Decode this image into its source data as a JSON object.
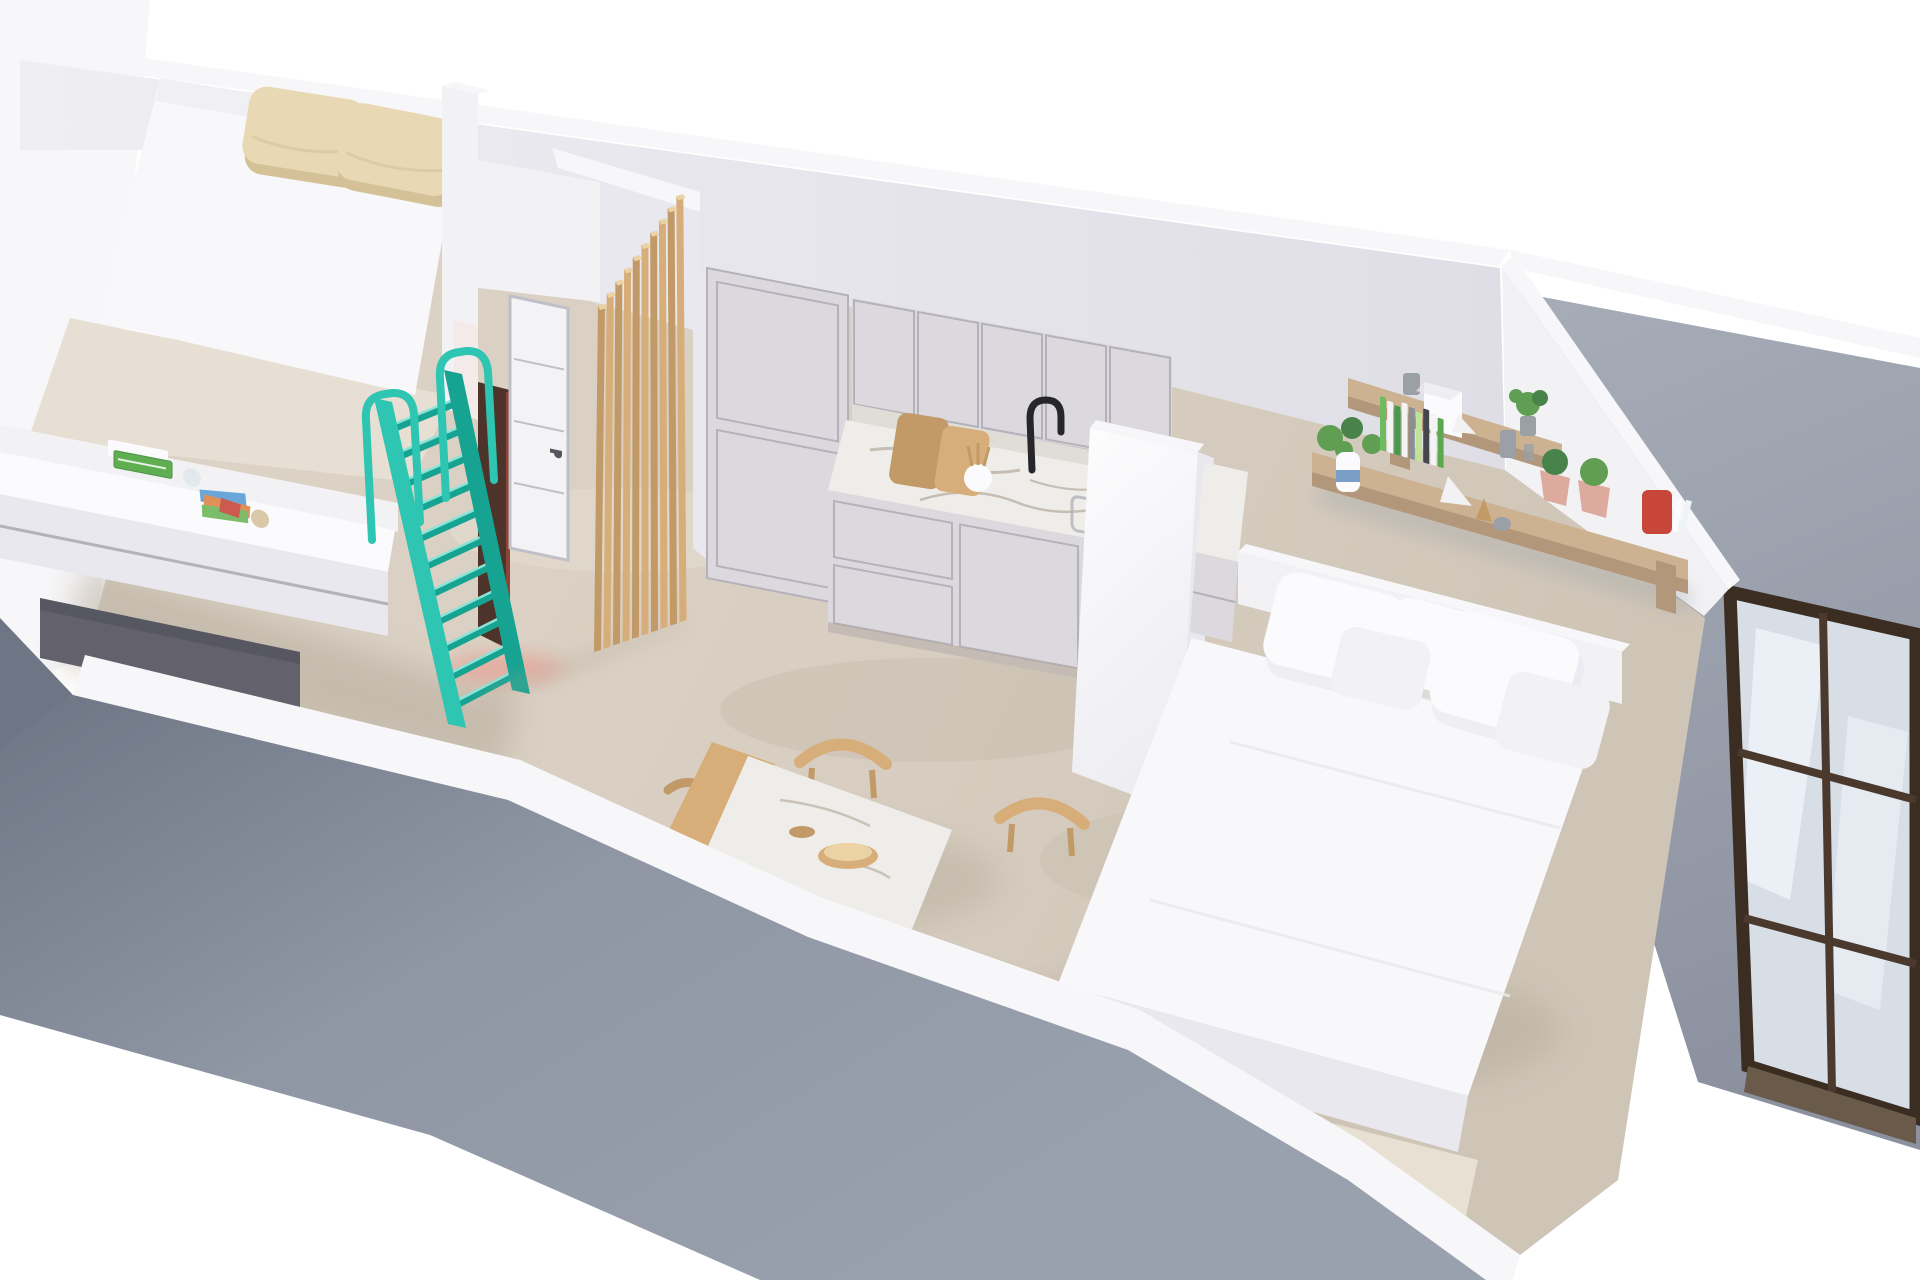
{
  "scene": {
    "type": "3d-floorplan-render",
    "label": "Isometric 3D render of a small studio apartment: loft bedroom, desk nook, turquoise loft ladder, white interior door, wooden slat partition, kitchen with marble worktop, dining table with wooden chairs, white daybed sofa, wooden wall shelves and a bronze framed glass entry door",
    "rooms": {
      "bedroom_loft": "loft-bedroom-with-double-mattress",
      "study_nook": "desk-nook-under-loft",
      "hallway": "hallway-with-door-and-ladder",
      "kitchen": "kitchen-with-marble-worktop",
      "dining": "dining-area",
      "living": "living-area-with-daybed",
      "terrace": "entry-with-glass-door"
    }
  },
  "counts": {
    "slats": 10,
    "ladder_rungs": 11,
    "shelf_books": 9
  },
  "book_colors": [
    "#6ebc5d",
    "#f4f4f4",
    "#3f9e4d",
    "#f4f4f4",
    "#8a8f96",
    "#bfe39a",
    "#45454d",
    "#f4f4f4",
    "#5aa94f"
  ],
  "palette": {
    "bg": "#ffffff",
    "floor": "#d8cec1",
    "floorLight": "#e7dfd3",
    "floorShade": "#c2b8aa",
    "wallFace": "#e9e8ee",
    "wallFaceDark": "#dddce3",
    "wallTop": "#f7f6f8",
    "wallWhite": "#f2f1f4",
    "cutGray": "#8f96a4",
    "cutGrayDark": "#6e7584",
    "terrace": "#9ba1ad",
    "teal": "#2ec5b2",
    "tealDark": "#17a392",
    "tealLight": "#8ce4d8",
    "wood": "#d7ae79",
    "woodDark": "#c19a67",
    "woodLight": "#ecd3a6",
    "shelfWood": "#cdb292",
    "shelfSide": "#b3977a",
    "pillowBeige": "#e8d9b4",
    "pillowBeigeDark": "#d5c197",
    "mattress": "#f8f8fa",
    "whiteSoft": "#fbfbfd",
    "whiteShade": "#e8e8ee",
    "cabFace": "#dcd9de",
    "cabLine": "#b4b1bb",
    "marble": "#efede9",
    "marbleShade": "#e0ddd7",
    "vein": "#a3978a",
    "black": "#26262b",
    "doorWhite": "#f3f2f5",
    "doorFrame": "#bfbfc8",
    "openingDark": "#4e332a",
    "glow": "#ef9184",
    "bronze": "#4a392c",
    "bronzeDark": "#3b2d22",
    "glass": "#d7dee6",
    "glassLight": "#eef3f8",
    "red": "#c8453a",
    "plant": "#5f9e53",
    "plantDark": "#47834a",
    "potPink": "#dcab9e",
    "vaseBlue": "#7b9ec7",
    "grayItem": "#9aa0a6",
    "sill": "#6a5a4a",
    "rug": "#e9e1d3",
    "shadow": "#b2a798"
  }
}
